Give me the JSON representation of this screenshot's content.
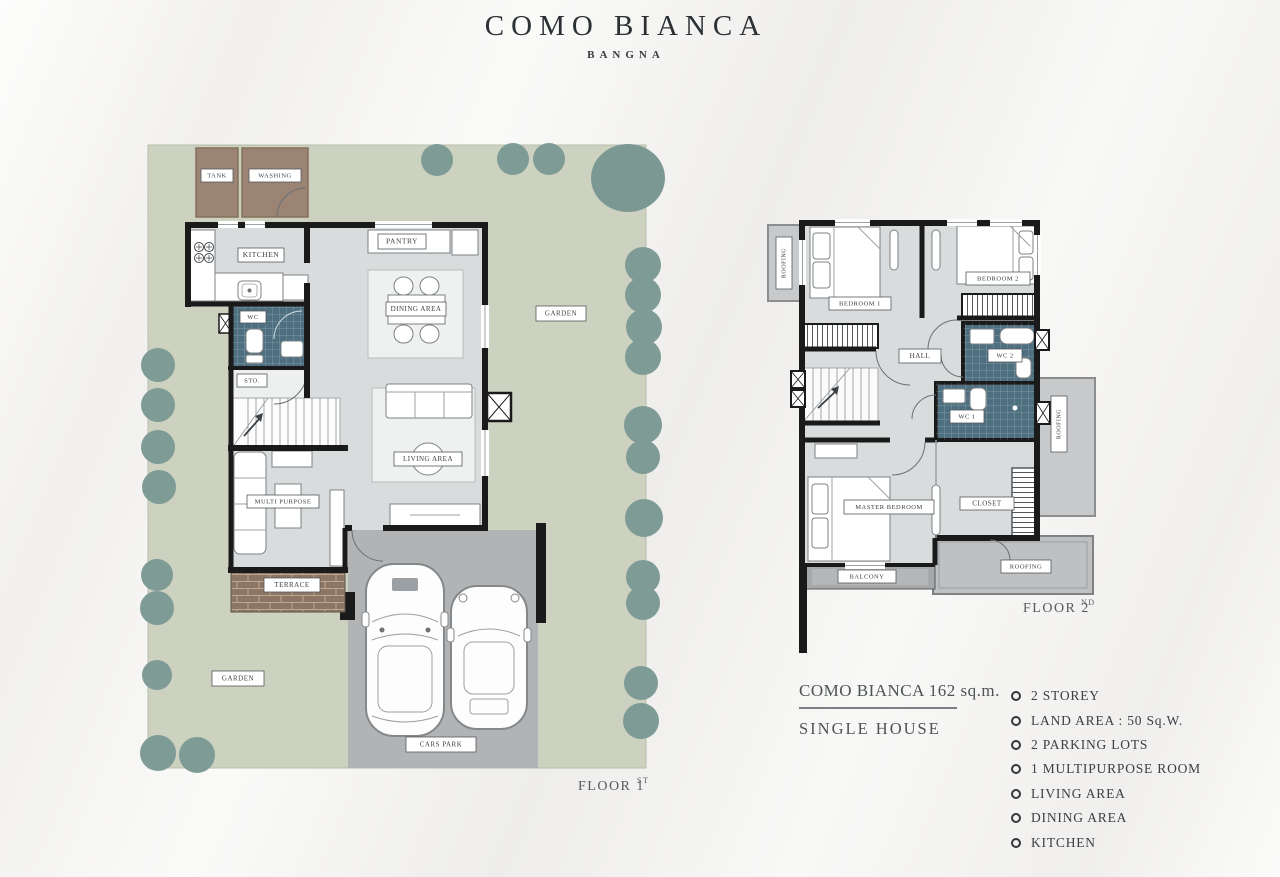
{
  "title": {
    "name": "COMO BIANCA",
    "location": "BANGNA"
  },
  "floor1": {
    "caption": {
      "label": "FLOOR 1",
      "sup": "ST"
    },
    "labels": {
      "tank": "TANK",
      "washing": "WASHING",
      "kitchen": "KITCHEN",
      "pantry": "PANTRY",
      "dining": "DINING AREA",
      "wc": "WC",
      "sto": "STO.",
      "living": "LIVING AREA",
      "multi": "MULTI PURPOSE",
      "terrace": "TERRACE",
      "garden": "GARDEN",
      "cars_park": "CARS PARK"
    }
  },
  "floor2": {
    "caption": {
      "label": "FLOOR 2",
      "sup": "ND"
    },
    "labels": {
      "roofing": "ROOFING",
      "bedroom1": "BEDROOM 1",
      "bedroom2": "BEDROOM 2",
      "hall": "HALL",
      "wc2": "WC 2",
      "wc1": "WC 1",
      "master": "MASTER BEDROOM",
      "closet": "CLOSET",
      "balcony": "BALCONY"
    }
  },
  "info": {
    "heading": "COMO BIANCA 162 sq.m.",
    "subheading": "SINGLE HOUSE",
    "features": [
      "2 STOREY",
      "LAND AREA : 50 Sq.W.",
      "2 PARKING LOTS",
      "1 MULTIPURPOSE ROOM",
      "LIVING AREA",
      "DINING AREA",
      "KITCHEN"
    ]
  },
  "colors": {
    "garden": "#ccd1c0",
    "tree": "#7e9b95",
    "wall": "#1a1a1a",
    "floor": "#d9dcdd",
    "wc_tile": "#4e6f80",
    "terrace_brick": "#8d7565",
    "service_brown": "#9b8474",
    "car_park": "#b1b3b5",
    "roofing": "#c7c9cb",
    "balcony": "#a6a8aa"
  }
}
